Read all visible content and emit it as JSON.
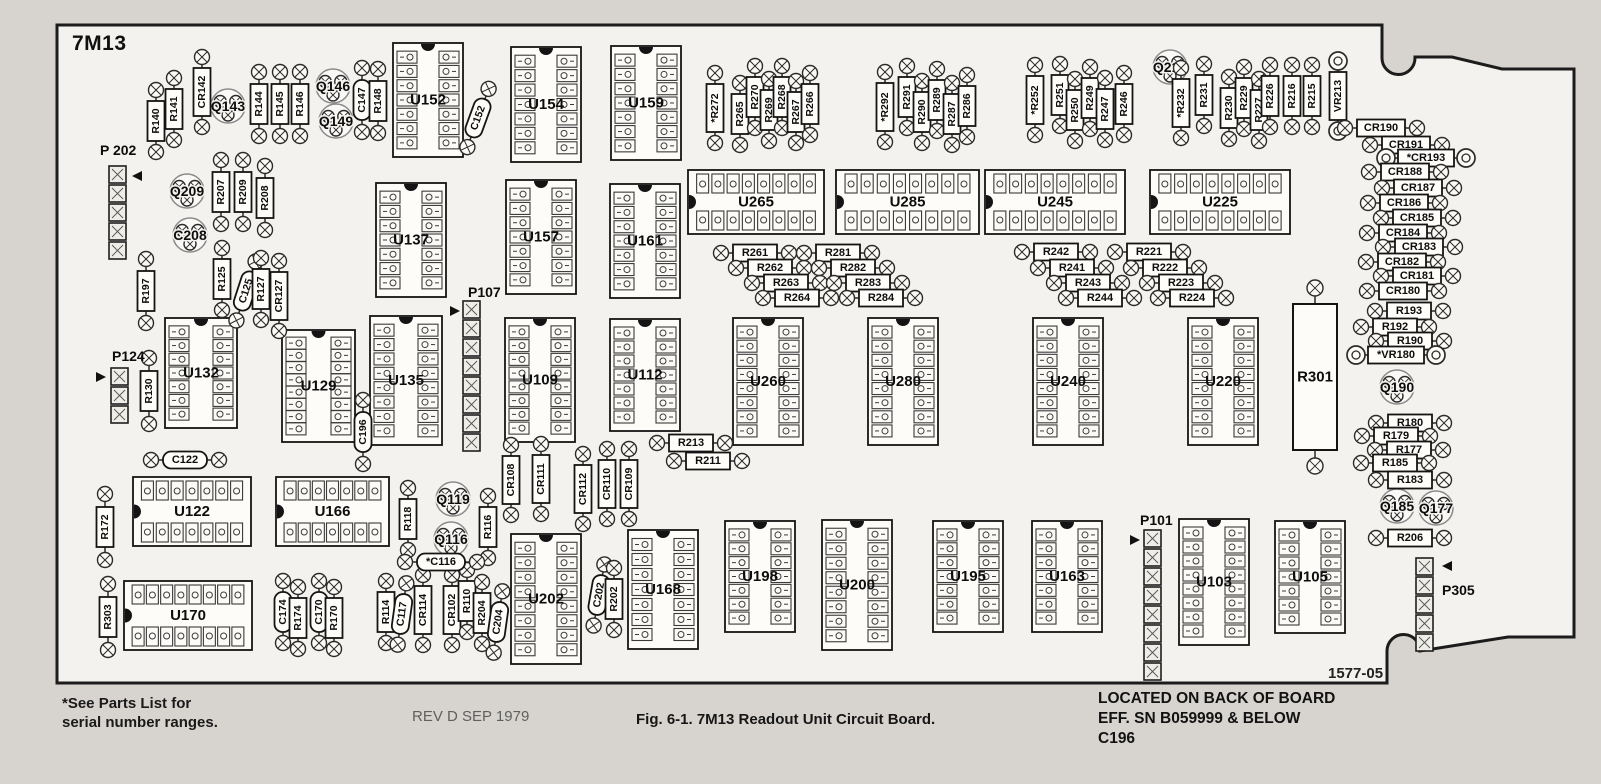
{
  "page": {
    "background": "#d7d4cf",
    "board_fill": "#f4f2ee",
    "line_color": "#1c1c1c"
  },
  "header": {
    "board_name": "7M13"
  },
  "footer": {
    "footnote_line1": "*See Parts List for",
    "footnote_line2": "serial number ranges.",
    "revision": "REV D SEP 1979",
    "caption": "Fig. 6-1. 7M13 Readout Unit Circuit Board.",
    "back_note_line1": "LOCATED ON BACK OF BOARD",
    "back_note_line2": "EFF. SN B059999 & BELOW",
    "back_note_line3": "C196",
    "board_code": "1577-05"
  },
  "board": {
    "outline_path": "M 57 25 H 1382 V 58 A 16.5 16.5 0 0 0 1415 58 V 57 H 1452 L 1502 69 H 1574 V 637 H 1508 L 1420 651 A 16.5 16.5 0 0 0 1387 651 V 683 H 57 Z",
    "ics_vertical": [
      {
        "l": "U152",
        "x": 393,
        "y": 43,
        "w": 70,
        "h": 114,
        "pins": 7
      },
      {
        "l": "U154",
        "x": 511,
        "y": 47,
        "w": 70,
        "h": 115,
        "pins": 7
      },
      {
        "l": "U159",
        "x": 611,
        "y": 46,
        "w": 70,
        "h": 114,
        "pins": 7
      },
      {
        "l": "U137",
        "x": 376,
        "y": 183,
        "w": 70,
        "h": 114,
        "pins": 7
      },
      {
        "l": "U157",
        "x": 506,
        "y": 180,
        "w": 70,
        "h": 114,
        "pins": 7
      },
      {
        "l": "U161",
        "x": 610,
        "y": 184,
        "w": 70,
        "h": 114,
        "pins": 7
      },
      {
        "l": "U132",
        "x": 165,
        "y": 318,
        "w": 72,
        "h": 110,
        "pins": 7
      },
      {
        "l": "U129",
        "x": 282,
        "y": 330,
        "w": 73,
        "h": 112,
        "pins": 8
      },
      {
        "l": "U135",
        "x": 370,
        "y": 316,
        "w": 72,
        "h": 129,
        "pins": 8
      },
      {
        "l": "U109",
        "x": 505,
        "y": 318,
        "w": 70,
        "h": 124,
        "pins": 8
      },
      {
        "l": "U112",
        "x": 610,
        "y": 319,
        "w": 70,
        "h": 112,
        "pins": 7
      },
      {
        "l": "U260",
        "x": 733,
        "y": 318,
        "w": 70,
        "h": 127,
        "pins": 8
      },
      {
        "l": "U280",
        "x": 868,
        "y": 318,
        "w": 70,
        "h": 127,
        "pins": 8
      },
      {
        "l": "U240",
        "x": 1033,
        "y": 318,
        "w": 70,
        "h": 127,
        "pins": 8
      },
      {
        "l": "U220",
        "x": 1188,
        "y": 318,
        "w": 70,
        "h": 127,
        "pins": 8
      },
      {
        "l": "U202",
        "x": 511,
        "y": 534,
        "w": 70,
        "h": 130,
        "pins": 8
      },
      {
        "l": "U168",
        "x": 628,
        "y": 530,
        "w": 70,
        "h": 119,
        "pins": 7
      },
      {
        "l": "U198",
        "x": 725,
        "y": 521,
        "w": 70,
        "h": 111,
        "pins": 7
      },
      {
        "l": "U200",
        "x": 822,
        "y": 520,
        "w": 70,
        "h": 130,
        "pins": 8
      },
      {
        "l": "U195",
        "x": 933,
        "y": 521,
        "w": 70,
        "h": 111,
        "pins": 7
      },
      {
        "l": "U163",
        "x": 1032,
        "y": 521,
        "w": 70,
        "h": 111,
        "pins": 7
      },
      {
        "l": "U103",
        "x": 1179,
        "y": 519,
        "w": 70,
        "h": 126,
        "pins": 8
      },
      {
        "l": "U105",
        "x": 1275,
        "y": 521,
        "w": 70,
        "h": 112,
        "pins": 7
      }
    ],
    "ics_horizontal": [
      {
        "l": "U265",
        "x": 688,
        "y": 170,
        "w": 136,
        "h": 64,
        "pins": 8
      },
      {
        "l": "U285",
        "x": 836,
        "y": 170,
        "w": 143,
        "h": 64,
        "pins": 8
      },
      {
        "l": "U245",
        "x": 985,
        "y": 170,
        "w": 140,
        "h": 64,
        "pins": 8
      },
      {
        "l": "U225",
        "x": 1150,
        "y": 170,
        "w": 140,
        "h": 64,
        "pins": 8
      },
      {
        "l": "U122",
        "x": 133,
        "y": 477,
        "w": 118,
        "h": 69,
        "pins": 7
      },
      {
        "l": "U166",
        "x": 276,
        "y": 477,
        "w": 113,
        "h": 69,
        "pins": 7
      },
      {
        "l": "U170",
        "x": 124,
        "y": 581,
        "w": 128,
        "h": 69,
        "pins": 8
      }
    ],
    "axial_vertical": [
      {
        "l": "R140",
        "x": 156,
        "y": 121
      },
      {
        "l": "R141",
        "x": 174,
        "y": 109
      },
      {
        "l": "CR142",
        "x": 202,
        "y": 92,
        "len": 70
      },
      {
        "l": "R144",
        "x": 259,
        "y": 104,
        "len": 64
      },
      {
        "l": "R145",
        "x": 280,
        "y": 104,
        "len": 64
      },
      {
        "l": "R146",
        "x": 300,
        "y": 104,
        "len": 64
      },
      {
        "l": "C147",
        "x": 362,
        "y": 100,
        "len": 64,
        "cap": true
      },
      {
        "l": "R148",
        "x": 378,
        "y": 101,
        "len": 64
      },
      {
        "l": "C152",
        "x": 478,
        "y": 118,
        "len": 58,
        "rot": 20,
        "cap": true
      },
      {
        "l": "R207",
        "x": 221,
        "y": 192,
        "len": 64
      },
      {
        "l": "R209",
        "x": 243,
        "y": 192,
        "len": 64
      },
      {
        "l": "R208",
        "x": 265,
        "y": 198,
        "len": 64
      },
      {
        "l": "R197",
        "x": 146,
        "y": 291,
        "len": 64
      },
      {
        "l": "R125",
        "x": 222,
        "y": 279,
        "len": 60
      },
      {
        "l": "C125",
        "x": 246,
        "y": 291,
        "len": 58,
        "rot": 18,
        "cap": true
      },
      {
        "l": "R127",
        "x": 261,
        "y": 289,
        "len": 58
      },
      {
        "l": "CR127",
        "x": 279,
        "y": 296,
        "len": 58
      },
      {
        "l": "R130",
        "x": 149,
        "y": 391,
        "len": 66
      },
      {
        "l": "R172",
        "x": 105,
        "y": 527,
        "len": 66
      },
      {
        "l": "R303",
        "x": 108,
        "y": 617,
        "len": 66
      },
      {
        "l": "C174",
        "x": 283,
        "y": 612,
        "len": 58,
        "cap": true
      },
      {
        "l": "R174",
        "x": 298,
        "y": 618,
        "len": 58
      },
      {
        "l": "C170",
        "x": 319,
        "y": 612,
        "len": 58,
        "cap": true
      },
      {
        "l": "R170",
        "x": 334,
        "y": 618,
        "len": 58
      },
      {
        "l": "R114",
        "x": 386,
        "y": 612,
        "len": 56
      },
      {
        "l": "C117",
        "x": 402,
        "y": 614,
        "len": 60,
        "rot": 8,
        "cap": true
      },
      {
        "l": "CR114",
        "x": 423,
        "y": 610,
        "len": 58
      },
      {
        "l": "CR102",
        "x": 452,
        "y": 610,
        "len": 58
      },
      {
        "l": "R110",
        "x": 467,
        "y": 601,
        "len": 56
      },
      {
        "l": "R204",
        "x": 482,
        "y": 613,
        "len": 56
      },
      {
        "l": "C204",
        "x": 498,
        "y": 622,
        "len": 58,
        "rot": 8,
        "cap": true
      },
      {
        "l": "R118",
        "x": 408,
        "y": 519,
        "len": 60
      },
      {
        "l": "R116",
        "x": 488,
        "y": 527,
        "len": 60
      },
      {
        "l": "C202",
        "x": 599,
        "y": 595,
        "len": 56,
        "rot": 10,
        "cap": true
      },
      {
        "l": "R202",
        "x": 614,
        "y": 599,
        "len": 56
      },
      {
        "l": "CR108",
        "x": 511,
        "y": 480,
        "len": 60
      },
      {
        "l": "CR111",
        "x": 541,
        "y": 479,
        "len": 60
      },
      {
        "l": "CR112",
        "x": 583,
        "y": 489,
        "len": 60
      },
      {
        "l": "CR110",
        "x": 607,
        "y": 484,
        "len": 60
      },
      {
        "l": "CR109",
        "x": 629,
        "y": 484,
        "len": 60
      },
      {
        "l": "C196",
        "x": 363,
        "y": 432,
        "len": 64,
        "cap": true
      },
      {
        "l": "*R272",
        "x": 715,
        "y": 108,
        "len": 64
      },
      {
        "l": "R265",
        "x": 740,
        "y": 114,
        "len": 60
      },
      {
        "l": "R270",
        "x": 755,
        "y": 97,
        "len": 60
      },
      {
        "l": "R269",
        "x": 769,
        "y": 110,
        "len": 60
      },
      {
        "l": "R268",
        "x": 782,
        "y": 97,
        "len": 60
      },
      {
        "l": "R267",
        "x": 796,
        "y": 112,
        "len": 60
      },
      {
        "l": "R266",
        "x": 810,
        "y": 104,
        "len": 60
      },
      {
        "l": "*R292",
        "x": 885,
        "y": 107,
        "len": 64
      },
      {
        "l": "R291",
        "x": 907,
        "y": 97,
        "len": 60
      },
      {
        "l": "R290",
        "x": 922,
        "y": 112,
        "len": 60
      },
      {
        "l": "R289",
        "x": 937,
        "y": 100,
        "len": 60
      },
      {
        "l": "R287",
        "x": 952,
        "y": 114,
        "len": 60
      },
      {
        "l": "R286",
        "x": 967,
        "y": 106,
        "len": 60
      },
      {
        "l": "*R252",
        "x": 1035,
        "y": 100,
        "len": 64
      },
      {
        "l": "R251",
        "x": 1060,
        "y": 95,
        "len": 60
      },
      {
        "l": "R250",
        "x": 1075,
        "y": 110,
        "len": 60
      },
      {
        "l": "R249",
        "x": 1090,
        "y": 98,
        "len": 60
      },
      {
        "l": "R247",
        "x": 1105,
        "y": 109,
        "len": 60
      },
      {
        "l": "R246",
        "x": 1124,
        "y": 104,
        "len": 60
      },
      {
        "l": "*R232",
        "x": 1181,
        "y": 103,
        "len": 64
      },
      {
        "l": "R231",
        "x": 1204,
        "y": 95,
        "len": 60
      },
      {
        "l": "R230",
        "x": 1229,
        "y": 108,
        "len": 60
      },
      {
        "l": "R229",
        "x": 1244,
        "y": 98,
        "len": 60
      },
      {
        "l": "R227",
        "x": 1259,
        "y": 110,
        "len": 60
      },
      {
        "l": "R226",
        "x": 1270,
        "y": 96,
        "len": 60
      },
      {
        "l": "R216",
        "x": 1292,
        "y": 96,
        "len": 60
      },
      {
        "l": "R215",
        "x": 1312,
        "y": 96,
        "len": 60
      },
      {
        "l": "VR213",
        "x": 1338,
        "y": 96,
        "len": 62,
        "ring": true
      }
    ],
    "axial_horizontal": [
      {
        "l": "R261",
        "x": 755,
        "y": 253
      },
      {
        "l": "R262",
        "x": 770,
        "y": 268
      },
      {
        "l": "R263",
        "x": 786,
        "y": 283
      },
      {
        "l": "R264",
        "x": 797,
        "y": 298
      },
      {
        "l": "R281",
        "x": 838,
        "y": 253
      },
      {
        "l": "R282",
        "x": 853,
        "y": 268
      },
      {
        "l": "R283",
        "x": 868,
        "y": 283
      },
      {
        "l": "R284",
        "x": 881,
        "y": 298
      },
      {
        "l": "R242",
        "x": 1056,
        "y": 252
      },
      {
        "l": "R241",
        "x": 1072,
        "y": 268
      },
      {
        "l": "R243",
        "x": 1088,
        "y": 283
      },
      {
        "l": "R244",
        "x": 1100,
        "y": 298
      },
      {
        "l": "R221",
        "x": 1149,
        "y": 252
      },
      {
        "l": "R222",
        "x": 1165,
        "y": 268
      },
      {
        "l": "R223",
        "x": 1181,
        "y": 283
      },
      {
        "l": "R224",
        "x": 1192,
        "y": 298
      },
      {
        "l": "R213",
        "x": 691,
        "y": 443
      },
      {
        "l": "R211",
        "x": 708,
        "y": 461
      },
      {
        "l": "*C116",
        "x": 441,
        "y": 562,
        "cap": true
      },
      {
        "l": "C122",
        "x": 185,
        "y": 460,
        "cap": true
      },
      {
        "l": "R206",
        "x": 1410,
        "y": 538
      },
      {
        "l": "CR190",
        "x": 1381,
        "y": 128
      },
      {
        "l": "CR191",
        "x": 1406,
        "y": 145
      },
      {
        "l": "*CR193",
        "x": 1426,
        "y": 158,
        "ring": true
      },
      {
        "l": "CR188",
        "x": 1405,
        "y": 172
      },
      {
        "l": "CR187",
        "x": 1418,
        "y": 188
      },
      {
        "l": "CR186",
        "x": 1404,
        "y": 203
      },
      {
        "l": "CR185",
        "x": 1417,
        "y": 218
      },
      {
        "l": "CR184",
        "x": 1403,
        "y": 233
      },
      {
        "l": "CR183",
        "x": 1419,
        "y": 247
      },
      {
        "l": "CR182",
        "x": 1402,
        "y": 262
      },
      {
        "l": "CR181",
        "x": 1417,
        "y": 276
      },
      {
        "l": "CR180",
        "x": 1403,
        "y": 291
      },
      {
        "l": "R193",
        "x": 1409,
        "y": 311
      },
      {
        "l": "R192",
        "x": 1395,
        "y": 327
      },
      {
        "l": "R190",
        "x": 1410,
        "y": 341
      },
      {
        "l": "*VR180",
        "x": 1396,
        "y": 355,
        "ring": true
      },
      {
        "l": "R180",
        "x": 1410,
        "y": 423
      },
      {
        "l": "R179",
        "x": 1396,
        "y": 436
      },
      {
        "l": "R177",
        "x": 1409,
        "y": 450
      },
      {
        "l": "R185",
        "x": 1395,
        "y": 463
      },
      {
        "l": "R183",
        "x": 1410,
        "y": 480
      }
    ],
    "transistors": [
      {
        "l": "Q143",
        "x": 228,
        "y": 106
      },
      {
        "l": "Q146",
        "x": 333,
        "y": 86
      },
      {
        "l": "Q149",
        "x": 336,
        "y": 121
      },
      {
        "l": "Q209",
        "x": 187,
        "y": 191
      },
      {
        "l": "C208",
        "x": 190,
        "y": 235
      },
      {
        "l": "Q216",
        "x": 1170,
        "y": 67
      },
      {
        "l": "Q190",
        "x": 1397,
        "y": 387
      },
      {
        "l": "Q185",
        "x": 1397,
        "y": 506
      },
      {
        "l": "Q177",
        "x": 1436,
        "y": 508
      },
      {
        "l": "Q119",
        "x": 453,
        "y": 499
      },
      {
        "l": "Q116",
        "x": 451,
        "y": 539
      }
    ],
    "connectors": [
      {
        "l": "P 202",
        "lx": 100,
        "ly": 150,
        "x": 109,
        "y0": 166,
        "count": 5,
        "ax": 142,
        "ay": 176,
        "dir": "left"
      },
      {
        "l": "P124",
        "lx": 112,
        "ly": 356,
        "x": 111,
        "y0": 368,
        "count": 3,
        "ax": 96,
        "ay": 377,
        "dir": "right"
      },
      {
        "l": "P107",
        "lx": 468,
        "ly": 292,
        "x": 463,
        "y0": 301,
        "count": 8,
        "ax": 450,
        "ay": 311,
        "dir": "right"
      },
      {
        "l": "P101",
        "lx": 1140,
        "ly": 520,
        "x": 1144,
        "y0": 530,
        "count": 8,
        "ax": 1130,
        "ay": 540,
        "dir": "right"
      },
      {
        "l": "P305",
        "lx": 1442,
        "ly": 590,
        "x": 1416,
        "y0": 558,
        "count": 5,
        "ax": 1452,
        "ay": 566,
        "dir": "left"
      }
    ],
    "power_resistor": {
      "l": "R301",
      "x": 1293,
      "y": 304,
      "w": 44,
      "h": 146
    }
  }
}
